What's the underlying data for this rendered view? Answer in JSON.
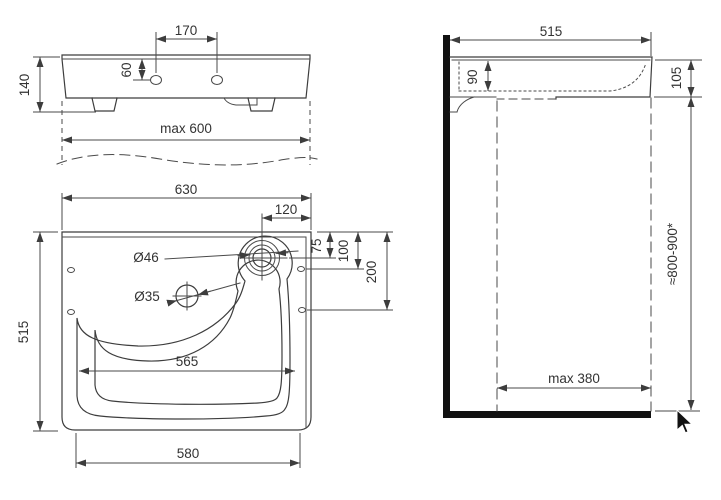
{
  "meta": {
    "drawing_type": "washbasin installation dimension drawing",
    "bg_color": "#ffffff",
    "line_color": "#3d3d3d",
    "heavy_color": "#111111",
    "text_color": "#333333"
  },
  "views": {
    "front": {
      "name": "front view",
      "labels": {
        "hole_spacing": "170",
        "hole_offset": "60",
        "body_height": "140",
        "max_width": "max 600"
      }
    },
    "top": {
      "name": "top view",
      "labels": {
        "overall_width": "630",
        "tap_offset": "120",
        "overall_depth": "515",
        "tap_hole_dia": "Ø46",
        "aux_hole_dia": "Ø35",
        "tap_from_edge": "75",
        "hole1_from_edge": "100",
        "hole2_from_edge": "200",
        "bowl_width": "565",
        "base_width": "580"
      }
    },
    "side": {
      "name": "side view",
      "labels": {
        "overall_depth": "515",
        "bowl_depth": "90",
        "front_height": "105",
        "install_height": "≈800-900*",
        "knee_clearance": "max 380"
      }
    }
  }
}
